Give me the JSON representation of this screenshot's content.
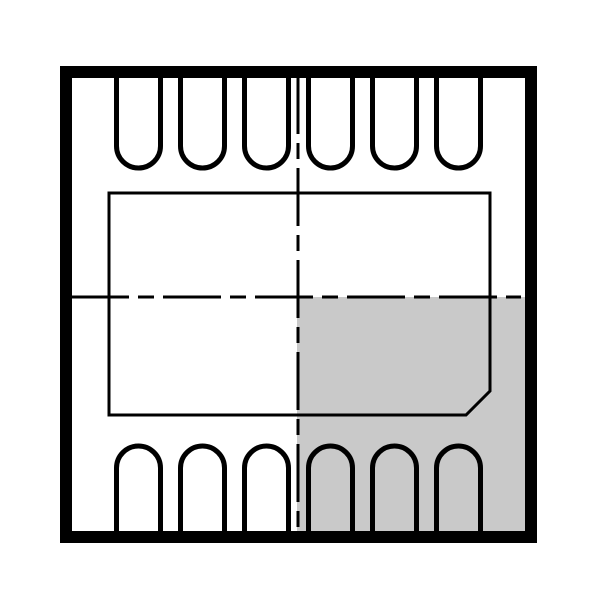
{
  "diagram": {
    "kind": "ic-package-outline-drawing",
    "description": "DFN-12 package top view: body outline, 6 top pins, 6 bottom pins, chamfered exposed pad, dashed centerlines, shaded bottom-right quadrant",
    "canvas": {
      "width": 600,
      "height": 599,
      "background_color": "#ffffff"
    },
    "colors": {
      "line": "#000000",
      "shaded_region_fill": "#c9c9c9",
      "background": "#ffffff"
    },
    "package_body": {
      "x": 66,
      "y": 72,
      "width": 465,
      "height": 465,
      "stroke_width": 12
    },
    "shaded_quadrant": {
      "position": "bottom-right",
      "x": 297,
      "y": 297,
      "width": 228,
      "height": 234
    },
    "exposed_pad": {
      "left": 109,
      "top": 193,
      "right": 490,
      "bottom": 415,
      "chamfer": 24,
      "chamfered_corner": "bottom-right",
      "stroke_width": 3
    },
    "center_lines": {
      "vertical_x": 298,
      "vertical_y1": 76,
      "vertical_y2": 532,
      "horizontal_y": 297,
      "horizontal_x1": 71,
      "horizontal_x2": 521,
      "stroke_width": 3,
      "dash_array": "58 9 16 9"
    },
    "pins": {
      "per_row": 6,
      "rows": [
        "top",
        "bottom"
      ],
      "centers_x": [
        138.5,
        202.5,
        266.5,
        330.5,
        394.5,
        458.5
      ],
      "half_width": 22,
      "corner_radius": 22,
      "stroke_width": 5,
      "top_row": {
        "outer_y": 70,
        "straight_to_y": 146
      },
      "bottom_row": {
        "outer_y": 533,
        "straight_to_y": 468
      }
    }
  }
}
